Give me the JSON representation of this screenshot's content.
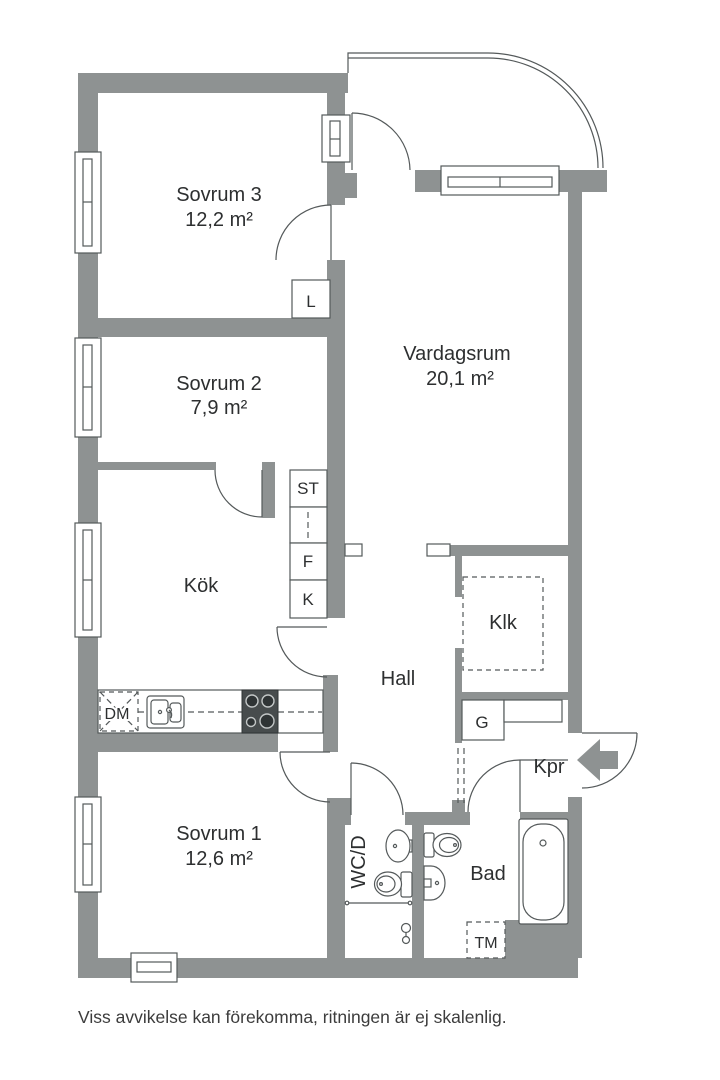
{
  "colors": {
    "wall": "#8e9292",
    "line": "#54595a",
    "text": "#2d2f30",
    "stove_dark": "#474c4d"
  },
  "rooms": {
    "sovrum3": {
      "name": "Sovrum 3",
      "area": "12,2 m²"
    },
    "sovrum2": {
      "name": "Sovrum 2",
      "area": "7,9 m²"
    },
    "vardagsrum": {
      "name": "Vardagsrum",
      "area": "20,1 m²"
    },
    "sovrum1": {
      "name": "Sovrum 1",
      "area": "12,6 m²"
    },
    "kok": {
      "name": "Kök"
    },
    "hall": {
      "name": "Hall"
    },
    "klk": {
      "name": "Klk"
    },
    "kpr": {
      "name": "Kpr"
    },
    "bad": {
      "name": "Bad"
    },
    "wcd": {
      "name": "WC/D"
    }
  },
  "labels": {
    "l": "L",
    "st": "ST",
    "f": "F",
    "k": "K",
    "g": "G",
    "dm": "DM",
    "tm": "TM"
  },
  "footer": {
    "disclaimer": "Viss avvikelse kan förekomma, ritningen är ej skalenlig."
  }
}
